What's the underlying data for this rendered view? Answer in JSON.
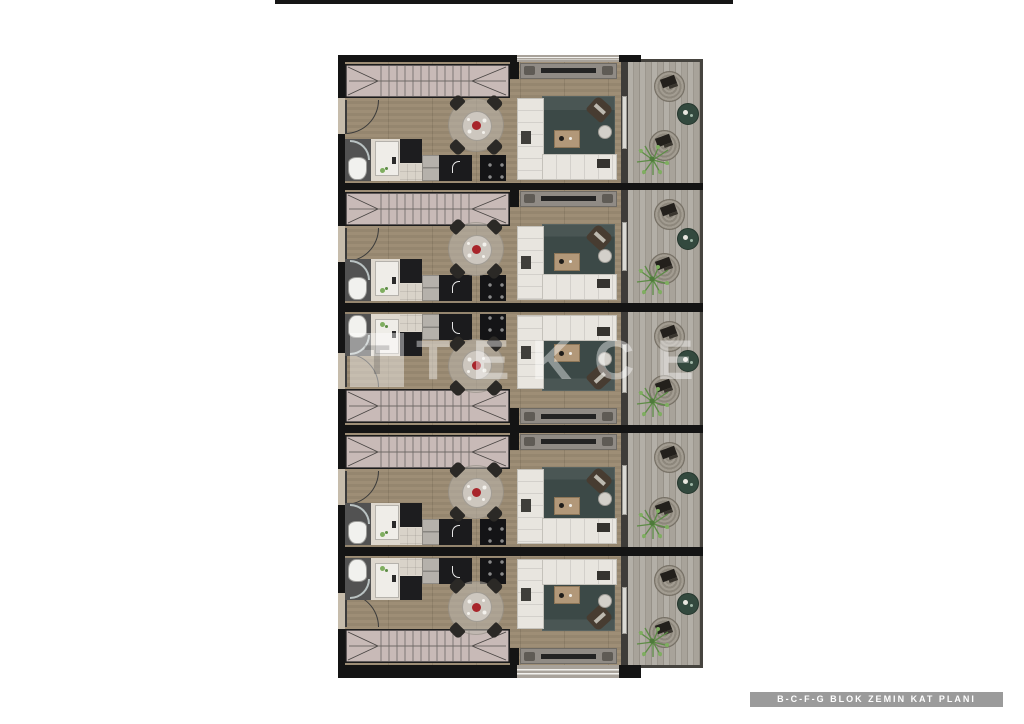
{
  "page": {
    "width": 1024,
    "height": 724,
    "background": "#ffffff"
  },
  "watermark": {
    "logo_glyph": "T",
    "text": "TEKCE"
  },
  "caption": {
    "text": "B-C-F-G BLOK ZEMIN KAT PLANI"
  },
  "plan": {
    "type": "architectural-floor-plan",
    "units": [
      {
        "id": 1,
        "orientation": "standard"
      },
      {
        "id": 2,
        "orientation": "standard"
      },
      {
        "id": 3,
        "orientation": "mirrored"
      },
      {
        "id": 4,
        "orientation": "standard"
      },
      {
        "id": 5,
        "orientation": "mirrored"
      }
    ],
    "unit_rooms": [
      "staircase",
      "entry-hall",
      "bathroom",
      "kitchen",
      "dining-area",
      "living-room",
      "balcony"
    ],
    "colors": {
      "wall": "#141414",
      "wood_floor": "#c6bcab",
      "stair_tread": "#c8bab7",
      "living_rug": "#3c4947",
      "sofa": "#e8e5df",
      "balcony_deck": "#aba69d",
      "balcony_table": "#33493e",
      "plant": "#6a9a50",
      "flower_accent": "#a8252b",
      "window_band": "#a8a29a",
      "caption_bg": "#9b9b9b",
      "caption_text": "#ffffff"
    }
  }
}
